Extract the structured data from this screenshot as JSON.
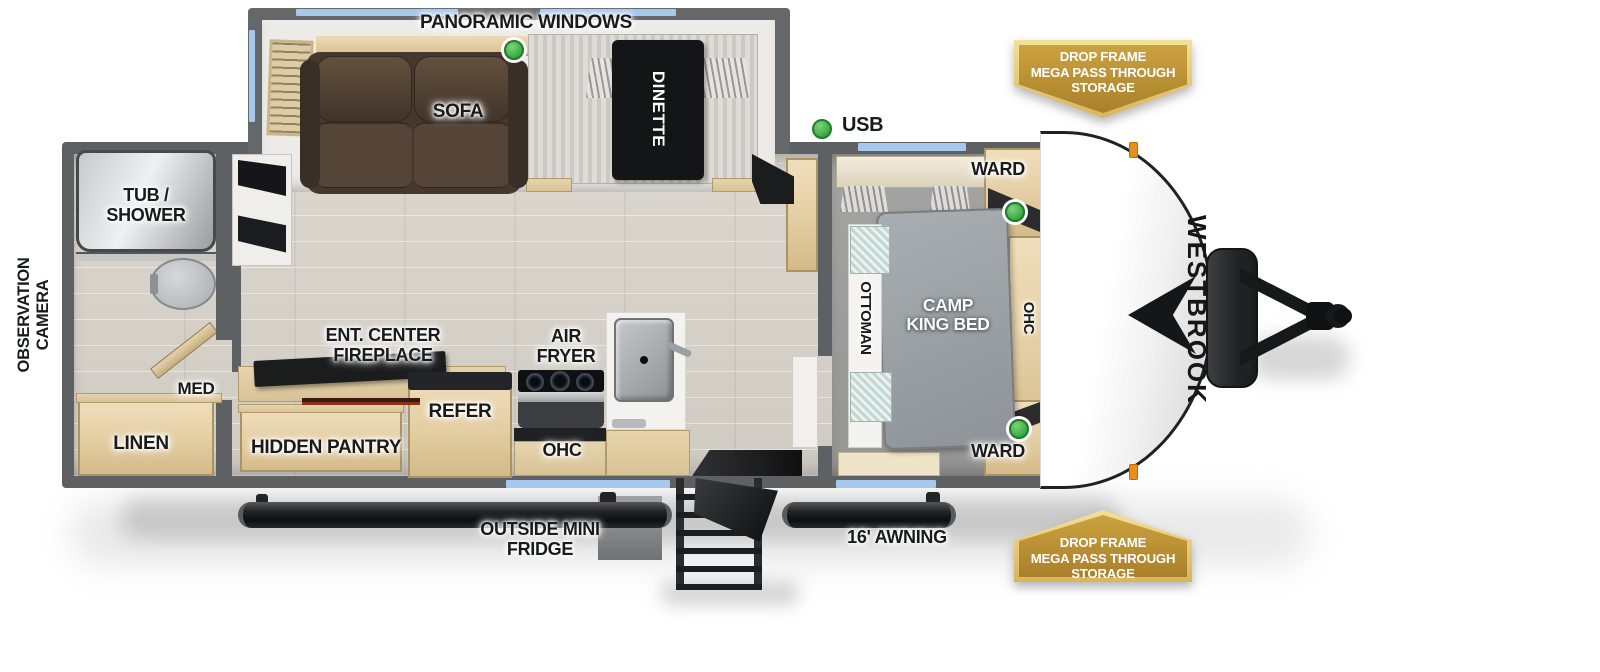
{
  "document": {
    "type": "travel trailer floorplan",
    "brand": "WESTBROOK"
  },
  "callouts": {
    "panoramic_windows": "PANORAMIC WINDOWS",
    "usb": "USB",
    "awning": "16' AWNING",
    "outside_mini_fridge": "OUTSIDE MINI FRIDGE",
    "observation_camera": "OBSERVATION CAMERA"
  },
  "badges": {
    "top": {
      "lines": [
        "DROP FRAME",
        "MEGA PASS THROUGH",
        "STORAGE"
      ]
    },
    "bottom": {
      "lines": [
        "DROP FRAME",
        "MEGA PASS THROUGH",
        "STORAGE"
      ]
    }
  },
  "rooms": {
    "bathroom": {
      "tub_shower": "TUB / SHOWER",
      "med": "MED",
      "linen": "LINEN"
    },
    "living": {
      "sofa": "SOFA",
      "dinette": "DINETTE",
      "ent_center": "ENT. CENTER FIREPLACE",
      "hidden_pantry": "HIDDEN PANTRY",
      "refer": "REFER",
      "air_fryer": "AIR FRYER",
      "ohc": "OHC"
    },
    "bedroom": {
      "bed": "CAMP KING BED",
      "ottoman": "OTTOMAN",
      "ohc": "OHC",
      "ward_top": "WARD",
      "ward_bottom": "WARD"
    }
  },
  "colors": {
    "marker_green": "#3fb648",
    "window_blue": "#a6c8ec",
    "badge_gold": "#bb9238",
    "wall_gray": "#5d6164",
    "cap_white": "#f7f7f7"
  }
}
